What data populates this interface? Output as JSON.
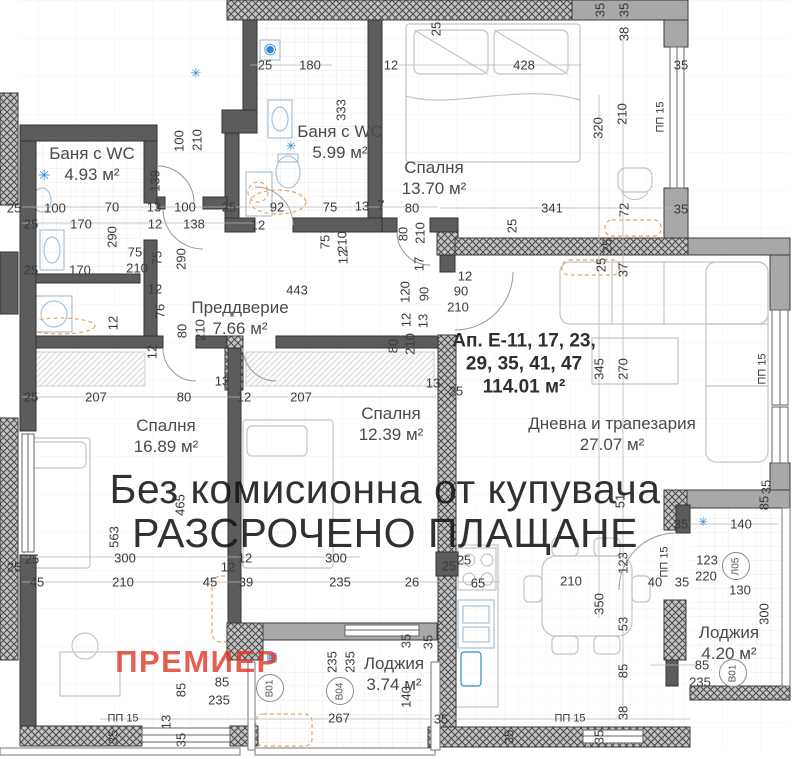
{
  "watermark": {
    "line1": "Без комисионна от купувача",
    "line2": "РАЗСРОЧЕНО ПЛАЩАНЕ"
  },
  "brand": {
    "name": "ПРЕМИЕР",
    "color": "#e03726"
  },
  "apartment": {
    "line1": "Ап. Е-11, 17, 23,",
    "line2": "29, 35, 41, 47",
    "line3": "114.01 м²"
  },
  "rooms": [
    {
      "name": "Баня с WC",
      "area": "4.93 м²",
      "x": 92,
      "y": 164
    },
    {
      "name": "Баня с WC",
      "area": "5.99 м²",
      "x": 340,
      "y": 142
    },
    {
      "name": "Спалня",
      "area": "13.70 м²",
      "x": 434,
      "y": 178
    },
    {
      "name": "Преддверие",
      "area": "7.66 м²",
      "x": 240,
      "y": 318
    },
    {
      "name": "Спалня",
      "area": "16.89 м²",
      "x": 166,
      "y": 436
    },
    {
      "name": "Спалня",
      "area": "12.39 м²",
      "x": 391,
      "y": 424
    },
    {
      "name": "Дневна и трапезария",
      "area": "27.07 м²",
      "x": 612,
      "y": 434
    },
    {
      "name": "Лоджия",
      "area": "3.74 м²",
      "x": 394,
      "y": 674
    },
    {
      "name": "Лоджия",
      "area": "4.20 м²",
      "x": 729,
      "y": 643
    }
  ],
  "markers": [
    {
      "t": "В01",
      "x": 270,
      "y": 688
    },
    {
      "t": "В04",
      "x": 340,
      "y": 691
    },
    {
      "t": "В01",
      "x": 733,
      "y": 673
    },
    {
      "t": "Л05",
      "x": 736,
      "y": 566
    }
  ],
  "fixtures": [
    {
      "name": "ac-unit-icon",
      "g": "✳",
      "x": 44,
      "y": 176,
      "c": "#2f86d4",
      "fs": 15
    },
    {
      "name": "ac-unit-icon",
      "g": "✳",
      "x": 196,
      "y": 73,
      "c": "#2f86d4",
      "fs": 13
    },
    {
      "name": "ac-unit-icon",
      "g": "✳",
      "x": 291,
      "y": 146,
      "c": "#2f86d4",
      "fs": 13
    },
    {
      "name": "ac-unit-icon",
      "g": "✳",
      "x": 703,
      "y": 522,
      "c": "#2f86d4",
      "fs": 12
    },
    {
      "name": "boiler-icon",
      "g": "◉",
      "x": 270,
      "y": 49,
      "c": "#2f86d4",
      "fs": 15
    },
    {
      "name": "vent-icon",
      "g": "▦",
      "x": 272,
      "y": 657,
      "c": "#2f86d4",
      "fs": 12
    }
  ],
  "dimensions": [
    {
      "t": "25",
      "x": 265,
      "y": 65
    },
    {
      "t": "180",
      "x": 310,
      "y": 65
    },
    {
      "t": "12",
      "x": 391,
      "y": 65
    },
    {
      "t": "333",
      "x": 341,
      "y": 110,
      "r": 1
    },
    {
      "t": "25",
      "x": 436,
      "y": 29,
      "r": 1
    },
    {
      "t": "428",
      "x": 524,
      "y": 65
    },
    {
      "t": "35",
      "x": 600,
      "y": 10,
      "r": 1
    },
    {
      "t": "35",
      "x": 624,
      "y": 10,
      "r": 1
    },
    {
      "t": "38",
      "x": 624,
      "y": 34,
      "r": 1
    },
    {
      "t": "35",
      "x": 681,
      "y": 65
    },
    {
      "t": "210",
      "x": 622,
      "y": 114,
      "r": 1
    },
    {
      "t": "320",
      "x": 598,
      "y": 128,
      "r": 1
    },
    {
      "t": "ПП 15",
      "x": 661,
      "y": 117,
      "r": 1
    },
    {
      "t": "341",
      "x": 552,
      "y": 208
    },
    {
      "t": "72",
      "x": 624,
      "y": 210,
      "r": 1
    },
    {
      "t": "35",
      "x": 681,
      "y": 209
    },
    {
      "t": "25",
      "x": 512,
      "y": 226,
      "r": 1
    },
    {
      "t": "25",
      "x": 607,
      "y": 246,
      "r": 1
    },
    {
      "t": "25",
      "x": 601,
      "y": 265,
      "r": 1
    },
    {
      "t": "37",
      "x": 623,
      "y": 270,
      "r": 1
    },
    {
      "t": "25",
      "x": 14,
      "y": 208
    },
    {
      "t": "100",
      "x": 55,
      "y": 208
    },
    {
      "t": "70",
      "x": 112,
      "y": 207
    },
    {
      "t": "13",
      "x": 154,
      "y": 207
    },
    {
      "t": "100",
      "x": 185,
      "y": 207
    },
    {
      "t": "25",
      "x": 229,
      "y": 207
    },
    {
      "t": "92",
      "x": 277,
      "y": 207
    },
    {
      "t": "75",
      "x": 330,
      "y": 207
    },
    {
      "t": "13",
      "x": 362,
      "y": 206
    },
    {
      "t": "7",
      "x": 381,
      "y": 205
    },
    {
      "t": "25",
      "x": 31,
      "y": 224
    },
    {
      "t": "170",
      "x": 81,
      "y": 224
    },
    {
      "t": "290",
      "x": 112,
      "y": 237,
      "r": 1
    },
    {
      "t": "12",
      "x": 155,
      "y": 224
    },
    {
      "t": "138",
      "x": 194,
      "y": 224
    },
    {
      "t": "12",
      "x": 258,
      "y": 225
    },
    {
      "t": "100",
      "x": 179,
      "y": 141,
      "r": 1
    },
    {
      "t": "210",
      "x": 197,
      "y": 140,
      "r": 1
    },
    {
      "t": "139",
      "x": 155,
      "y": 181,
      "r": 1
    },
    {
      "t": "75",
      "x": 135,
      "y": 252
    },
    {
      "t": "210",
      "x": 137,
      "y": 268
    },
    {
      "t": "75",
      "x": 157,
      "y": 258,
      "r": 1
    },
    {
      "t": "290",
      "x": 181,
      "y": 259,
      "r": 1
    },
    {
      "t": "25",
      "x": 31,
      "y": 270
    },
    {
      "t": "170",
      "x": 80,
      "y": 270
    },
    {
      "t": "12",
      "x": 113,
      "y": 323,
      "r": 1
    },
    {
      "t": "75",
      "x": 325,
      "y": 242,
      "r": 1
    },
    {
      "t": "210",
      "x": 342,
      "y": 242,
      "r": 1
    },
    {
      "t": "12",
      "x": 343,
      "y": 257,
      "r": 1
    },
    {
      "t": "80",
      "x": 412,
      "y": 208
    },
    {
      "t": "80",
      "x": 403,
      "y": 234,
      "r": 1
    },
    {
      "t": "210",
      "x": 420,
      "y": 233,
      "r": 1
    },
    {
      "t": "17",
      "x": 419,
      "y": 264,
      "r": 1
    },
    {
      "t": "12",
      "x": 465,
      "y": 276
    },
    {
      "t": "90",
      "x": 461,
      "y": 291
    },
    {
      "t": "210",
      "x": 458,
      "y": 307
    },
    {
      "t": "120",
      "x": 405,
      "y": 292,
      "r": 1
    },
    {
      "t": "90",
      "x": 424,
      "y": 294,
      "r": 1
    },
    {
      "t": "12",
      "x": 406,
      "y": 320,
      "r": 1
    },
    {
      "t": "13",
      "x": 423,
      "y": 321,
      "r": 1
    },
    {
      "t": "80",
      "x": 393,
      "y": 346,
      "r": 1
    },
    {
      "t": "210",
      "x": 410,
      "y": 344,
      "r": 1
    },
    {
      "t": "13",
      "x": 433,
      "y": 383
    },
    {
      "t": "25",
      "x": 456,
      "y": 391
    },
    {
      "t": "443",
      "x": 297,
      "y": 290
    },
    {
      "t": "12",
      "x": 155,
      "y": 289
    },
    {
      "t": "76",
      "x": 160,
      "y": 311,
      "r": 1
    },
    {
      "t": "12",
      "x": 152,
      "y": 352,
      "r": 1
    },
    {
      "t": "80",
      "x": 182,
      "y": 331,
      "r": 1
    },
    {
      "t": "210",
      "x": 200,
      "y": 330,
      "r": 1
    },
    {
      "t": "13",
      "x": 222,
      "y": 381
    },
    {
      "t": "80",
      "x": 184,
      "y": 397
    },
    {
      "t": "12",
      "x": 244,
      "y": 397
    },
    {
      "t": "207",
      "x": 301,
      "y": 397
    },
    {
      "t": "25",
      "x": 31,
      "y": 397
    },
    {
      "t": "207",
      "x": 96,
      "y": 397
    },
    {
      "t": "465",
      "x": 180,
      "y": 505,
      "r": 1
    },
    {
      "t": "563",
      "x": 114,
      "y": 537,
      "r": 1
    },
    {
      "t": "300",
      "x": 125,
      "y": 558
    },
    {
      "t": "25",
      "x": 32,
      "y": 559
    },
    {
      "t": "25",
      "x": 14,
      "y": 567
    },
    {
      "t": "45",
      "x": 37,
      "y": 582
    },
    {
      "t": "210",
      "x": 123,
      "y": 582
    },
    {
      "t": "12",
      "x": 245,
      "y": 558
    },
    {
      "t": "12",
      "x": 228,
      "y": 567
    },
    {
      "t": "45",
      "x": 210,
      "y": 582
    },
    {
      "t": "39",
      "x": 246,
      "y": 582
    },
    {
      "t": "300",
      "x": 336,
      "y": 558
    },
    {
      "t": "235",
      "x": 340,
      "y": 582
    },
    {
      "t": "26",
      "x": 412,
      "y": 582
    },
    {
      "t": "25",
      "x": 449,
      "y": 566
    },
    {
      "t": "65",
      "x": 478,
      "y": 583
    },
    {
      "t": "25",
      "x": 464,
      "y": 560
    },
    {
      "t": "210",
      "x": 571,
      "y": 581
    },
    {
      "t": "350",
      "x": 599,
      "y": 604,
      "r": 1
    },
    {
      "t": "123",
      "x": 623,
      "y": 563,
      "r": 1
    },
    {
      "t": "53",
      "x": 623,
      "y": 624,
      "r": 1
    },
    {
      "t": "85",
      "x": 623,
      "y": 671,
      "r": 1
    },
    {
      "t": "38",
      "x": 623,
      "y": 713,
      "r": 1
    },
    {
      "t": "51",
      "x": 620,
      "y": 501,
      "r": 1
    },
    {
      "t": "345",
      "x": 599,
      "y": 369,
      "r": 1
    },
    {
      "t": "270",
      "x": 623,
      "y": 369,
      "r": 1
    },
    {
      "t": "ПП 15",
      "x": 763,
      "y": 369,
      "r": 1
    },
    {
      "t": "35",
      "x": 766,
      "y": 487,
      "r": 1
    },
    {
      "t": "85",
      "x": 764,
      "y": 503,
      "r": 1
    },
    {
      "t": "40",
      "x": 655,
      "y": 582
    },
    {
      "t": "35",
      "x": 682,
      "y": 582
    },
    {
      "t": "ПП 15",
      "x": 665,
      "y": 562,
      "r": 1
    },
    {
      "t": "140",
      "x": 741,
      "y": 524
    },
    {
      "t": "35",
      "x": 681,
      "y": 524
    },
    {
      "t": "123",
      "x": 707,
      "y": 560
    },
    {
      "t": "220",
      "x": 706,
      "y": 576
    },
    {
      "t": "130",
      "x": 740,
      "y": 590
    },
    {
      "t": "300",
      "x": 764,
      "y": 614,
      "r": 1
    },
    {
      "t": "85",
      "x": 702,
      "y": 665
    },
    {
      "t": "235",
      "x": 700,
      "y": 682
    },
    {
      "t": "85",
      "x": 181,
      "y": 690,
      "r": 1
    },
    {
      "t": "85",
      "x": 222,
      "y": 682
    },
    {
      "t": "235",
      "x": 219,
      "y": 700
    },
    {
      "t": "235",
      "x": 332,
      "y": 662,
      "r": 1
    },
    {
      "t": "235",
      "x": 350,
      "y": 662,
      "r": 1
    },
    {
      "t": "267",
      "x": 339,
      "y": 718
    },
    {
      "t": "140",
      "x": 406,
      "y": 697,
      "r": 1
    },
    {
      "t": "ПП 15",
      "x": 123,
      "y": 719
    },
    {
      "t": "13",
      "x": 166,
      "y": 722,
      "r": 1
    },
    {
      "t": "35",
      "x": 113,
      "y": 737,
      "r": 1
    },
    {
      "t": "35",
      "x": 181,
      "y": 740,
      "r": 1
    },
    {
      "t": "35",
      "x": 441,
      "y": 719
    },
    {
      "t": "ПП 15",
      "x": 570,
      "y": 719
    },
    {
      "t": "35",
      "x": 509,
      "y": 737,
      "r": 1
    },
    {
      "t": "35",
      "x": 599,
      "y": 737,
      "r": 1
    },
    {
      "t": "35",
      "x": 406,
      "y": 641,
      "r": 1
    },
    {
      "t": "35",
      "x": 428,
      "y": 642,
      "r": 1
    }
  ]
}
